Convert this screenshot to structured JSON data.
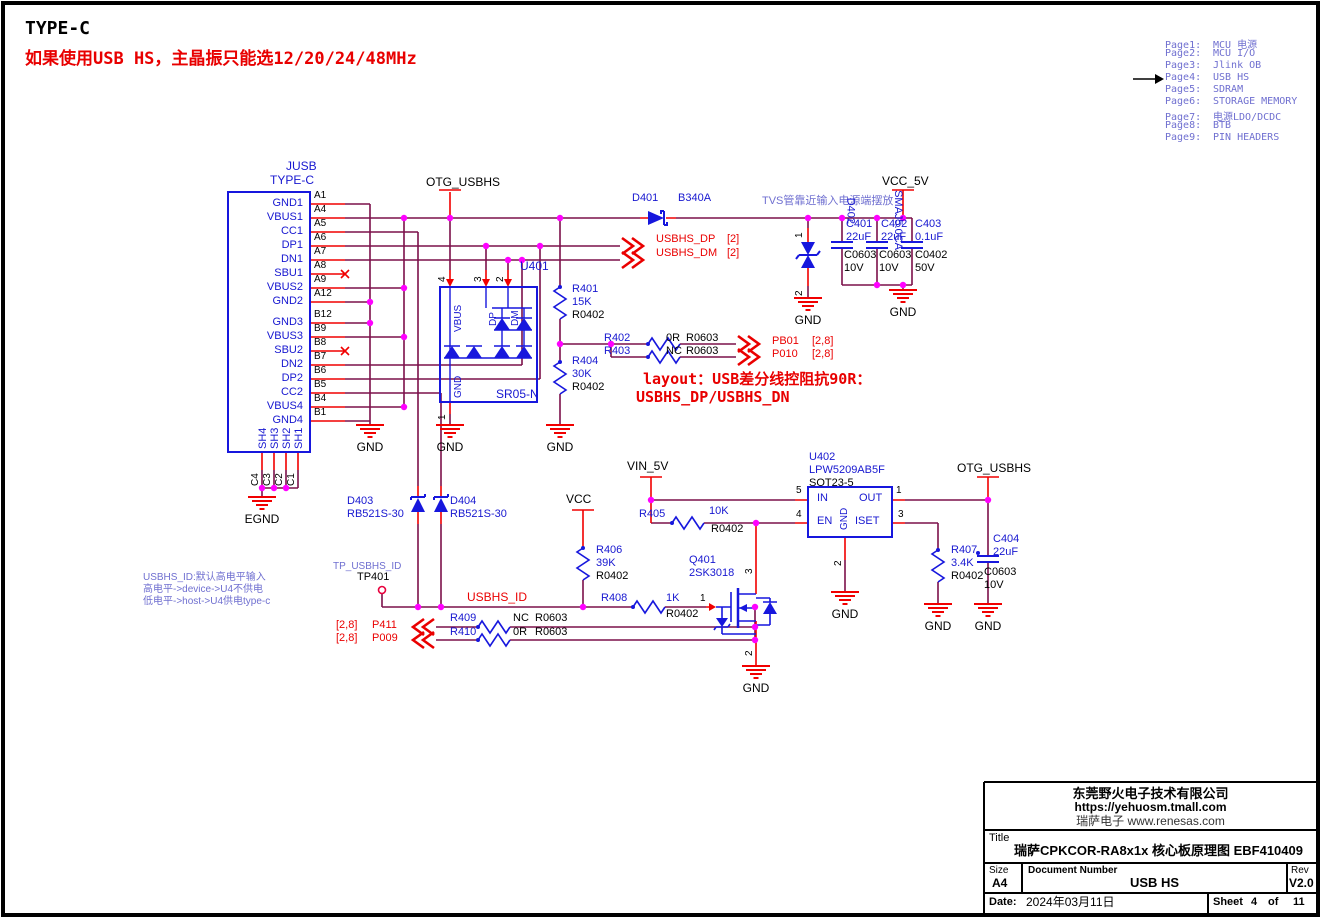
{
  "header": {
    "title": "TYPE-C",
    "subtitle": "如果使用USB HS，主晶振只能选12/20/24/48MHz"
  },
  "page_index": {
    "items": [
      {
        "num": "Page1:",
        "label": "MCU 电源"
      },
      {
        "num": "Page2:",
        "label": "MCU I/O"
      },
      {
        "num": "Page3:",
        "label": "Jlink OB"
      },
      {
        "num": "Page4:",
        "label": "USB HS"
      },
      {
        "num": "Page5:",
        "label": "SDRAM"
      },
      {
        "num": "Page6:",
        "label": "STORAGE MEMORY"
      },
      {
        "num": "Page7:",
        "label": "电源LDO/DCDC"
      },
      {
        "num": "Page8:",
        "label": "BTB"
      },
      {
        "num": "Page9:",
        "label": "PIN HEADERS"
      }
    ]
  },
  "connector": {
    "ref": "JUSB",
    "part": "TYPE-C",
    "egnd": "EGND",
    "pins_a": [
      {
        "name": "GND1",
        "num": "A1"
      },
      {
        "name": "VBUS1",
        "num": "A4"
      },
      {
        "name": "CC1",
        "num": "A5"
      },
      {
        "name": "DP1",
        "num": "A6"
      },
      {
        "name": "DN1",
        "num": "A7"
      },
      {
        "name": "SBU1",
        "num": "A8"
      },
      {
        "name": "VBUS2",
        "num": "A9"
      },
      {
        "name": "GND2",
        "num": "A12"
      }
    ],
    "pins_b": [
      {
        "name": "GND3",
        "num": "B12"
      },
      {
        "name": "VBUS3",
        "num": "B9"
      },
      {
        "name": "SBU2",
        "num": "B8"
      },
      {
        "name": "DN2",
        "num": "B7"
      },
      {
        "name": "DP2",
        "num": "B6"
      },
      {
        "name": "CC2",
        "num": "B5"
      },
      {
        "name": "VBUS4",
        "num": "B4"
      },
      {
        "name": "GND4",
        "num": "B1"
      }
    ],
    "shield_pins": [
      "SH4",
      "SH3",
      "SH2",
      "SH1"
    ],
    "shield_nums": [
      "C4",
      "C3",
      "C2",
      "C1"
    ]
  },
  "power": {
    "otg_top": "OTG_USBHS",
    "vcc_5v": "VCC_5V",
    "vin_5v": "VIN_5V",
    "vcc": "VCC",
    "otg_right": "OTG_USBHS",
    "gnd": "GND"
  },
  "nets": {
    "usbhs_dp": {
      "name": "USBHS_DP",
      "page": "[2]"
    },
    "usbhs_dm": {
      "name": "USBHS_DM",
      "page": "[2]"
    },
    "pb01": {
      "name": "PB01",
      "page": "[2,8]"
    },
    "p010": {
      "name": "P010",
      "page": "[2,8]"
    },
    "p411": {
      "name": "P411",
      "page": "[2,8]"
    },
    "p009": {
      "name": "P009",
      "page": "[2,8]"
    },
    "usbhs_id": "USBHS_ID",
    "tp_net": "TP_USBHS_ID"
  },
  "notes": {
    "tvs": "TVS管靠近输入电源端摆放",
    "layout1": "layout：USB差分线控阻抗90R：",
    "layout2": "USBHS_DP/USBHS_DN",
    "id1": "USBHS_ID:默认高电平输入",
    "id2": "高电平->device->U4不供电",
    "id3": "低电平->host->U4供电type-c"
  },
  "components": {
    "d401": {
      "ref": "D401",
      "val": "B340A"
    },
    "d402": {
      "ref": "D402",
      "val": "SMAJ5.0CA",
      "p1": "1",
      "p2": "2"
    },
    "d403": {
      "ref": "D403",
      "val": "RB521S-30"
    },
    "d404": {
      "ref": "D404",
      "val": "RB521S-30"
    },
    "u401": {
      "ref": "U401",
      "val": "SR05-N",
      "vbus": "VBUS",
      "dp": "DP",
      "dm": "DM",
      "gnd": "GND",
      "n4": "4",
      "n3": "3",
      "n2": "2",
      "n1": "1"
    },
    "u402": {
      "ref": "U402",
      "val": "LPW5209AB5F",
      "pkg": "SOT23-5",
      "in": "IN",
      "en": "EN",
      "gnd": "GND",
      "out": "OUT",
      "iset": "ISET",
      "n5": "5",
      "n4": "4",
      "n1": "1",
      "n3": "3",
      "n2": "2"
    },
    "q401": {
      "ref": "Q401",
      "val": "2SK3018",
      "ng": "1",
      "nd": "3",
      "ns": "2"
    },
    "tp401": {
      "ref": "TP401"
    },
    "r401": {
      "ref": "R401",
      "val": "15K",
      "fp": "R0402"
    },
    "r402": {
      "ref": "R402",
      "val": "0R",
      "fp": "R0603"
    },
    "r403": {
      "ref": "R403",
      "val": "NC",
      "fp": "R0603"
    },
    "r404": {
      "ref": "R404",
      "val": "30K",
      "fp": "R0402"
    },
    "r405": {
      "ref": "R405",
      "val": "10K",
      "fp": "R0402"
    },
    "r406": {
      "ref": "R406",
      "val": "39K",
      "fp": "R0402"
    },
    "r407": {
      "ref": "R407",
      "val": "3.4K",
      "fp": "R0402"
    },
    "r408": {
      "ref": "R408",
      "val": "1K",
      "fp": "R0402"
    },
    "r409": {
      "ref": "R409",
      "val": "NC",
      "fp": "R0603"
    },
    "r410": {
      "ref": "R410",
      "val": "0R",
      "fp": "R0603"
    },
    "c401": {
      "ref": "C401",
      "val": "22uF",
      "fp": "C0603",
      "v": "10V"
    },
    "c402": {
      "ref": "C402",
      "val": "22uF",
      "fp": "C0603",
      "v": "10V"
    },
    "c403": {
      "ref": "C403",
      "val": "0.1uF",
      "fp": "C0402",
      "v": "50V"
    },
    "c404": {
      "ref": "C404",
      "val": "22uF",
      "fp": "C0603",
      "v": "10V"
    }
  },
  "title_block": {
    "company": "东莞野火电子技术有限公司",
    "url": "https://yehuosm.tmall.com",
    "renesas": "瑞萨电子 www.renesas.com",
    "title_label": "Title",
    "title": "瑞萨CPKCOR-RA8x1x 核心板原理图  EBF410409",
    "size_label": "Size",
    "size": "A4",
    "doc_label": "Document Number",
    "doc": "USB HS",
    "rev_label": "Rev",
    "rev": "V2.0",
    "date_label": "Date:",
    "date": "2024年03月11日",
    "sheet_label": "Sheet",
    "sheet": "4",
    "of_label": "of",
    "total": "11"
  }
}
